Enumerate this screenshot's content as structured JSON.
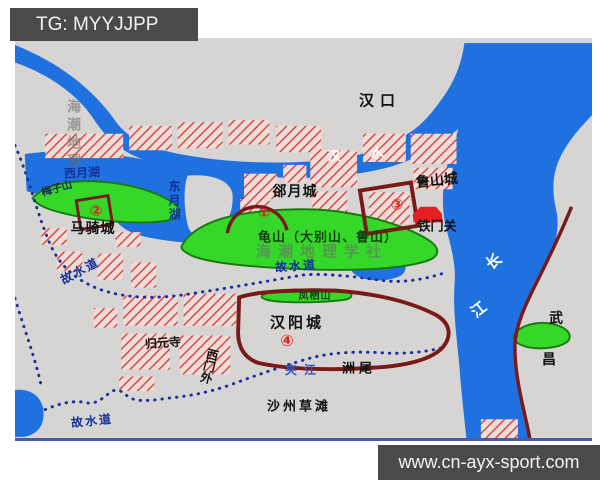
{
  "banners": {
    "top_left": "TG: MYYJJPP",
    "bottom_right": "www.cn-ayx-sport.com"
  },
  "watermarks": {
    "vertical": "海潮地理",
    "horizontal": "海潮地理学社"
  },
  "labels": {
    "hankou": "汉口",
    "hanshui": "汉 水",
    "xiyuehu": "西月湖",
    "dongyuehu": "东月湖",
    "meizishan": "梅子山",
    "maqicheng": "马骑城",
    "queyuecheng": "郤月城",
    "lushancheng": "鲁山城",
    "tiemenguan": "铁门关",
    "guishan": "龟山（大别山、鲁山）",
    "gushuidao": "故水道",
    "fengqishan": "凤栖山",
    "hanyangcheng": "汉阳城",
    "guiyuansi": "归元寺",
    "ximenwai": "西门外",
    "jiajiang": "夹江",
    "zhouwei": "洲尾",
    "shazhoucaotan": "沙州草滩",
    "changjiang_char1": "长",
    "changjiang_char2": "江",
    "wuchang_char1": "武",
    "wuchang_char2": "昌",
    "marker_1": "①",
    "marker_2": "②",
    "marker_3": "③",
    "marker_4": "④"
  },
  "colors": {
    "river_blue": "#2071e0",
    "land_gray": "#d7d5d3",
    "hill_green": "#35d829",
    "hill_outline": "#1a7a12",
    "wall_maroon": "#7a1a18",
    "urban_stripe": "#cf4a4a",
    "gate_red": "#e51f1f",
    "waterway_navy": "#1b2f9e",
    "banner_bg": "#4a4a49"
  }
}
